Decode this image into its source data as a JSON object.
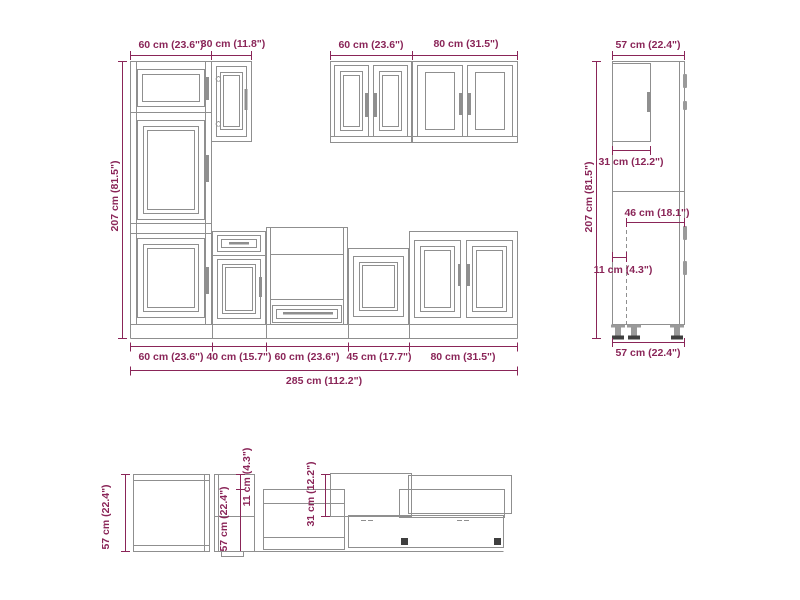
{
  "colors": {
    "background": "#ffffff",
    "line": "#8f8f8f",
    "dimension": "#8a2558",
    "dark": "#3f3f3f"
  },
  "front_elevation": {
    "height": "207 cm (81.5\")",
    "top_widths": [
      "60 cm (23.6\")",
      "30 cm (11.8\")"
    ],
    "wall_widths": [
      "60 cm (23.6\")",
      "80 cm (31.5\")"
    ],
    "base_widths": [
      "60 cm (23.6\")",
      "40 cm (15.7\")",
      "60 cm (23.6\")",
      "45 cm (17.7\")",
      "80 cm (31.5\")"
    ],
    "total_width": "285 cm (112.2\")"
  },
  "side_elevation": {
    "height": "207 cm (81.5\")",
    "top_depth": "57 cm (22.4\")",
    "upper_door_depth": "31 cm (12.2\")",
    "base_inner_depth": "46 cm (18.1\")",
    "front_offset": "11 cm (4.3\")",
    "bottom_depth": "57 cm (22.4\")"
  },
  "plan_view": {
    "left_depth": "57 cm (22.4\")",
    "inner_depth": "57 cm (22.4\")",
    "front_offset": "11 cm (4.3\")",
    "wall_cabinet_depth": "31 cm (12.2\")"
  }
}
